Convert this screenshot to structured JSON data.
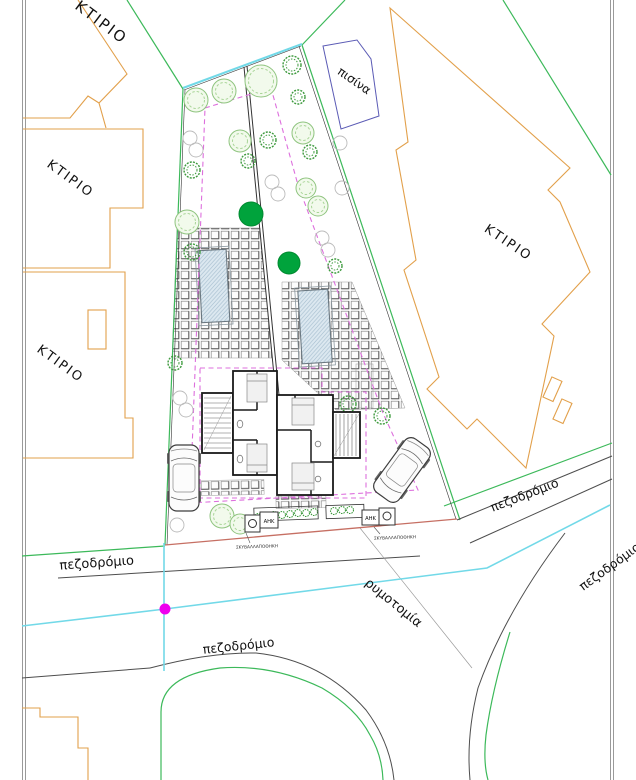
{
  "page": {
    "width": 636,
    "height": 780,
    "background": "#ffffff",
    "type": "architectural-site-plan"
  },
  "colors": {
    "neighbor_building": "#E2A04B",
    "boundary_green": "#3CB95A",
    "road_line": "#4D4D4D",
    "water_cyan": "#72D9E8",
    "setback_magenta": "#DD6FDD",
    "survey_dot": "#EE00EE",
    "street_widening_red": "#C66F63",
    "pool_outline_blue": "#5B5BB5",
    "pool_fill": "#DCE8F0",
    "tree_light": "#8FC47F",
    "tree_light_fill": "#F2FAEC",
    "tree_dark": "#3D9A3D",
    "tree_solid": "#00A33C",
    "gray_circle": "#BBBBBB",
    "plan_wall": "#1A1A1A",
    "border_gray": "#9A9A9A"
  },
  "labels": {
    "ktirio_top": "ΚΤΙΡΙΟ",
    "ktirio_left_upper": "ΚΤΙΡΙΟ",
    "ktirio_left_lower": "ΚΤΙΡΙΟ",
    "ktirio_right": "ΚΤΙΡΙΟ",
    "pisina": "πισίνα",
    "pezodromio_west": "πεζοδρόμιο",
    "pezodromio_south": "πεζοδρόμιο",
    "pezodromio_northeast": "πεζοδρόμιο",
    "pezodromio_east": "πεζοδρόμιο",
    "rymotomia": "ρυμοτομία",
    "garbage_left": "ΣΚΥΒΑΛΛΑΠΟΘΗΚΗ",
    "garbage_right": "ΣΚΥΒΑΛΛΑΠΟΘΗΚΗ",
    "ahk_left": "ΑΗΚ",
    "ahk_right": "ΑΗΚ"
  },
  "flora": {
    "light_trees": [
      [
        196,
        100,
        12
      ],
      [
        224,
        91,
        12
      ],
      [
        261,
        81,
        16
      ],
      [
        240,
        141,
        11
      ],
      [
        303,
        133,
        11
      ],
      [
        306,
        188,
        10
      ],
      [
        318,
        206,
        10
      ],
      [
        187,
        222,
        12
      ],
      [
        222,
        516,
        12
      ],
      [
        240,
        524,
        10
      ]
    ],
    "dark_shrubs": [
      [
        292,
        65,
        9
      ],
      [
        298,
        97,
        7
      ],
      [
        192,
        170,
        8
      ],
      [
        268,
        140,
        8
      ],
      [
        248,
        161,
        7
      ],
      [
        192,
        252,
        8
      ],
      [
        310,
        152,
        7
      ],
      [
        175,
        363,
        7
      ],
      [
        348,
        404,
        8
      ],
      [
        382,
        416,
        8
      ],
      [
        335,
        266,
        7
      ]
    ],
    "gray_circles": [
      [
        190,
        138,
        7
      ],
      [
        196,
        150,
        7
      ],
      [
        272,
        182,
        7
      ],
      [
        278,
        194,
        7
      ],
      [
        322,
        238,
        7
      ],
      [
        328,
        250,
        7
      ],
      [
        180,
        398,
        7
      ],
      [
        186,
        410,
        7
      ],
      [
        177,
        525,
        7
      ],
      [
        340,
        143,
        7
      ],
      [
        342,
        188,
        7
      ]
    ],
    "solid_trees": [
      [
        251,
        214,
        12
      ],
      [
        289,
        263,
        11
      ]
    ],
    "planter_plants": [
      [
        258,
        517
      ],
      [
        266,
        516
      ],
      [
        274,
        515
      ],
      [
        282,
        515
      ],
      [
        290,
        514
      ],
      [
        298,
        513
      ],
      [
        306,
        513
      ],
      [
        314,
        512
      ],
      [
        334,
        511
      ],
      [
        342,
        510
      ],
      [
        350,
        510
      ]
    ]
  }
}
